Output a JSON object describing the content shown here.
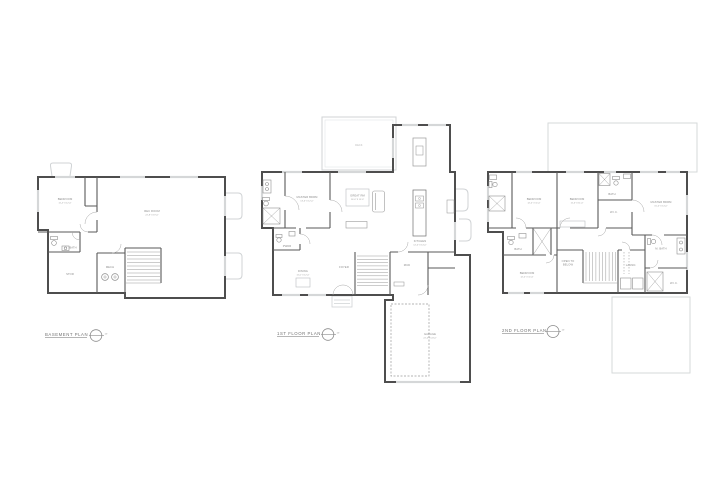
{
  "drawing": {
    "sheet_background": "#ffffff",
    "plans": [
      {
        "title": "BASEMENT PLAN",
        "scale": "1/4\"",
        "rooms": {
          "bedroom": {
            "name": "BEDROOM",
            "dims": "11'-4\" X 12'-0\""
          },
          "rec": {
            "name": "REC ROOM",
            "dims": "22'-8\" X 19'-6\""
          },
          "bath": {
            "name": "BATH"
          },
          "stor": {
            "name": "STOR"
          },
          "mech": {
            "name": "MECH"
          }
        }
      },
      {
        "title": "1ST FLOOR PLAN",
        "scale": "1/4\"",
        "rooms": {
          "master": {
            "name": "MASTER BDRM",
            "dims": "13'-6\" X 12'-0\""
          },
          "great": {
            "name": "GREAT RM",
            "dims": "16'-0\" X 15'-0\""
          },
          "kitchen": {
            "name": "KITCHEN",
            "dims": "12'-0\" X 14'-0\""
          },
          "dining": {
            "name": "DINING",
            "dims": "11'-0\" X 12'-0\""
          },
          "powder": {
            "name": "PWDR"
          },
          "foyer": {
            "name": "FOYER"
          },
          "mud": {
            "name": "MUD"
          },
          "garage": {
            "name": "GARAGE",
            "dims": "22'-0\" X 24'-0\""
          },
          "deck": {
            "name": "DECK"
          }
        }
      },
      {
        "title": "2ND FLOOR PLAN",
        "scale": "1/4\"",
        "rooms": {
          "bedroom2": {
            "name": "BEDROOM",
            "dims": "12'-0\" X 11'-0\""
          },
          "bedroom3": {
            "name": "BEDROOM",
            "dims": "11'-6\" X 11'-0\""
          },
          "master": {
            "name": "MASTER BDRM",
            "dims": "15'-0\" X 14'-0\""
          },
          "bedroom4": {
            "name": "BEDROOM",
            "dims": "12'-0\" X 11'-6\""
          },
          "bath2": {
            "name": "BATH"
          },
          "bath3": {
            "name": "BATH"
          },
          "wic": {
            "name": "W.I.C."
          },
          "wic2": {
            "name": "W.I.C."
          },
          "laundry": {
            "name": "LAUND."
          },
          "master_bath": {
            "name": "M. BATH"
          },
          "open_to_below": {
            "line1": "OPEN TO",
            "line2": "BELOW"
          }
        }
      }
    ],
    "colors": {
      "wall": "#4e4e4e",
      "interior_wall": "#5a5a5a",
      "fixture": "#8f8f8f",
      "light_outline": "#d0d3d5",
      "label": "#8c8c8c",
      "title": "#737373"
    }
  }
}
